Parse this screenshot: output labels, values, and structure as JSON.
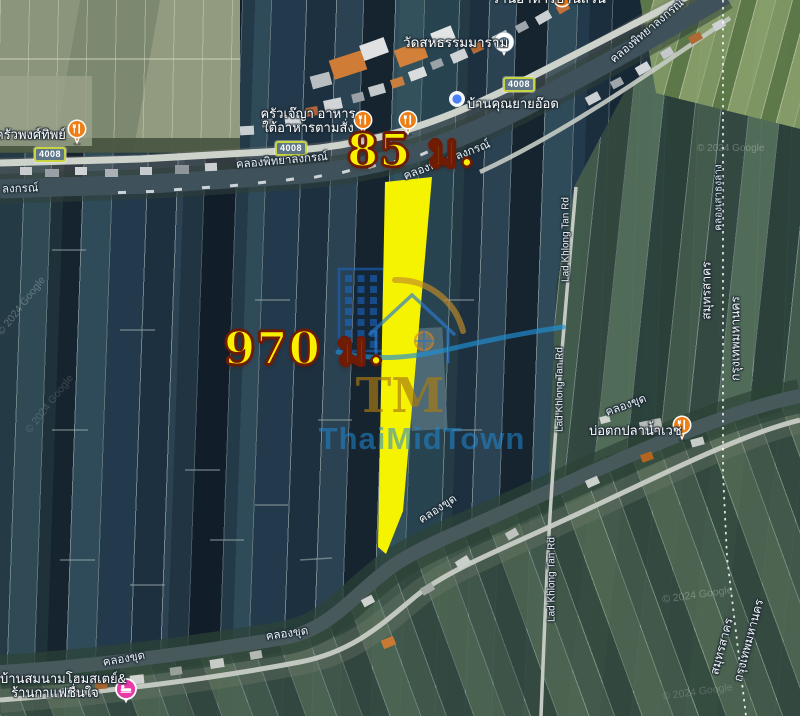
{
  "map": {
    "measurements": {
      "width": "85 ม.",
      "length": "970 ม."
    },
    "pois": {
      "temple": {
        "label": "วัดสหธรรมมาราม"
      },
      "krua_je_ya": {
        "line1": "ครัวเจ๊ญา อาหาร",
        "line2": "ใต้อาหารตามสั่ง"
      },
      "ban_khun_yai_od": {
        "label": "บ้านคุณยายอ๊อด"
      },
      "krua_phong_sak_thip": {
        "label": "ครัวพงศ์ทิพย์"
      },
      "bo_tok_pla_nam_wet": {
        "label": "บ่อตกปลาน้ำเวช"
      },
      "homestay": {
        "line1": "บ้านสมนามโฮมสเตย์&",
        "line2": "ร้านกาแฟชื่นใจ"
      },
      "top_clipped": {
        "label": "ร้านอาหารบ้านสวน"
      }
    },
    "roads": {
      "route_number": "4008",
      "lad_khlong_tan": "Lad Khlong Tan Rd"
    },
    "waterways": {
      "phitthayalongkon": "คลองพิทยาลงกรณ์",
      "phitthayalongkon_fragment": "ลงกรณ์",
      "khlong_khut": "คลองขุด",
      "sao_thong": "คลองเสาธงล่าง"
    },
    "admin": {
      "province_left": "สมุทรสาคร",
      "province_right": "กรุงเทพมหานคร"
    },
    "credit": "© 2024 Google",
    "brand": {
      "name": "ThaiMidTown",
      "monogram": "TM"
    },
    "colors": {
      "parcel_highlight": "#f6f300",
      "measure_text": "#f9f000",
      "poi_pin_orange": "#ee7e16",
      "homestay_pin_pink": "#ea3aa8",
      "marker_dot_blue": "#4a80f5",
      "route_badge_border": "#c7d53e"
    }
  }
}
